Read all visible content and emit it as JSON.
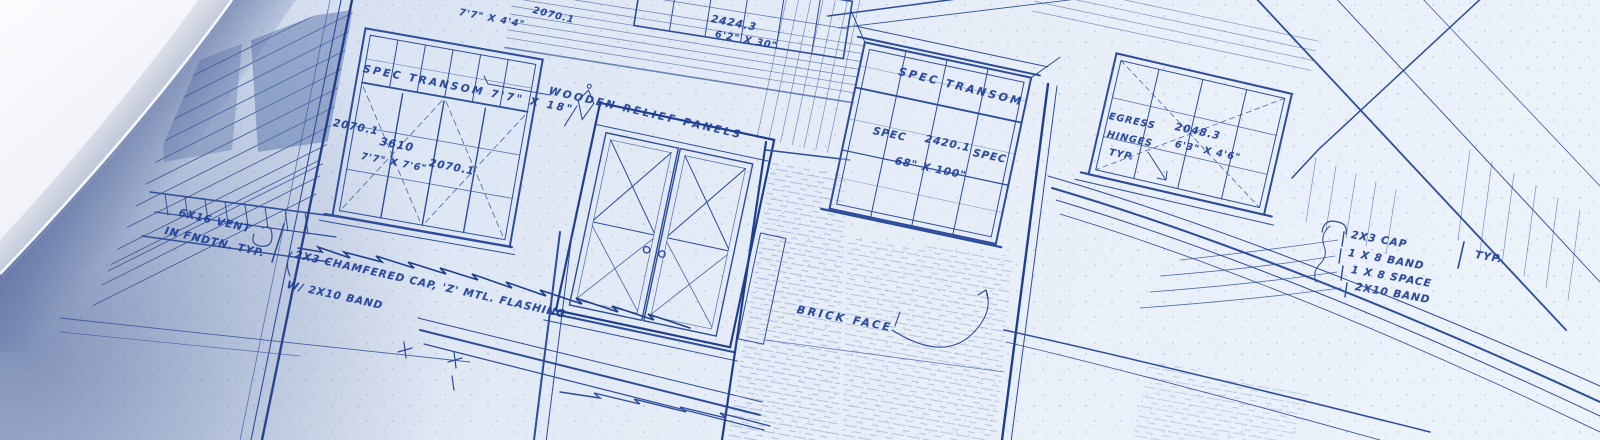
{
  "scene": {
    "subject": "hand-drawn architectural blueprint of a house front elevation",
    "style": "blue ink linework on blueprint paper, photographed at an angle with a curled page corner at top-left"
  },
  "colors": {
    "ink": "#2c4c9c",
    "ink_dark": "#1f3e8e",
    "paper": "#e7eef8",
    "paper_shadow": "#6c82b2",
    "curled_page": "#f7f9fc"
  },
  "annotations": [
    {
      "text": "SPEC TRANSOM 7'7\" X 18\""
    },
    {
      "text": "2070.1"
    },
    {
      "text": "3610"
    },
    {
      "text": "7'7\" X 7'6\""
    },
    {
      "text": "2070.1"
    },
    {
      "text": "7'7\" X 4'4\""
    },
    {
      "text": "2070.1"
    },
    {
      "text": "WOODEN RELIEF PANELS"
    },
    {
      "text": "2424.3"
    },
    {
      "text": "6'2\" X 30\""
    },
    {
      "text": "SPEC TRANSOM"
    },
    {
      "text": "SPEC"
    },
    {
      "text": "2420.1"
    },
    {
      "text": "SPEC"
    },
    {
      "text": "68\" X 100\""
    },
    {
      "text": "EGRESS"
    },
    {
      "text": "2048.3"
    },
    {
      "text": "HINGES"
    },
    {
      "text": "6'3\" X 4'6\""
    },
    {
      "text": "TYP."
    },
    {
      "text": "BRICK FACE"
    },
    {
      "text": "6X16 VENT"
    },
    {
      "text": "IN FNDTN. TYP."
    },
    {
      "text": "2X3 CHAMFERED CAP, 'Z' MTL. FLASHING"
    },
    {
      "text": "W/ 2X10 BAND"
    },
    {
      "text": "2X3 CAP"
    },
    {
      "text": "1 X 8 BAND"
    },
    {
      "text": "1 X 8 SPACE"
    },
    {
      "text": "2X10 BAND"
    },
    {
      "text": "TYP."
    }
  ]
}
